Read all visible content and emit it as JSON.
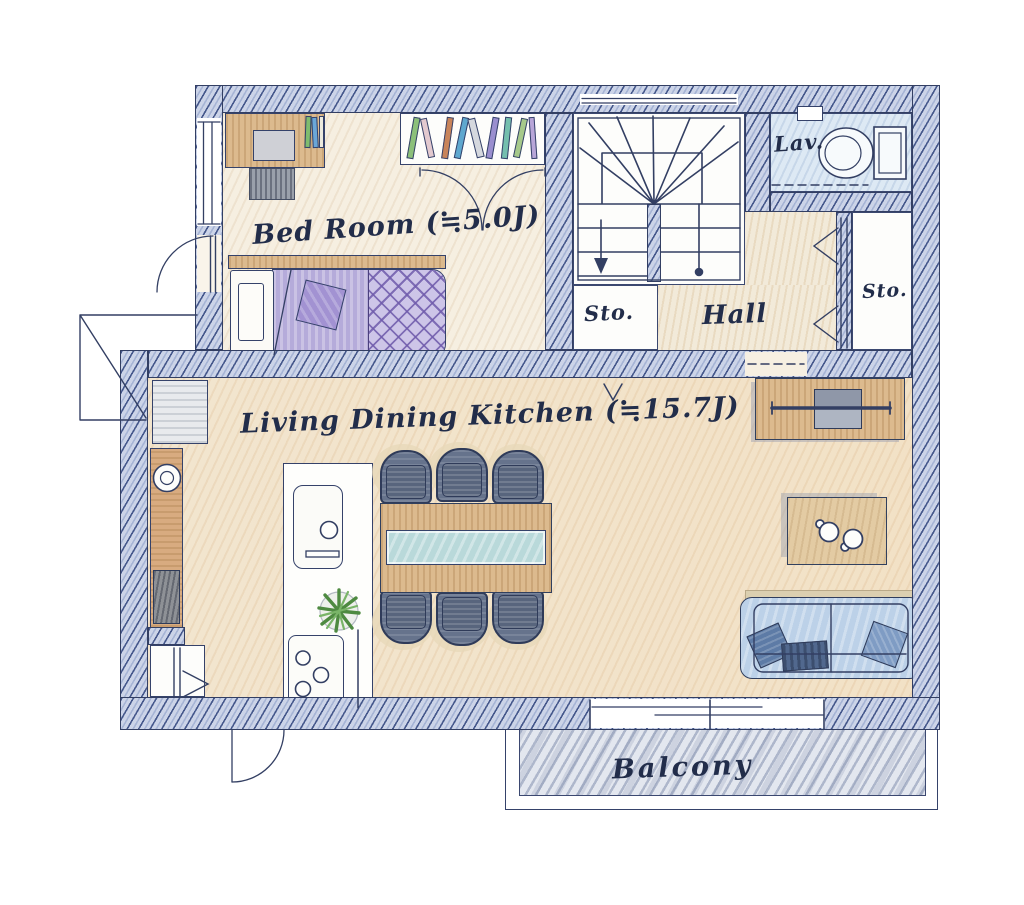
{
  "rooms": {
    "bedroom": {
      "label": "Bed Room (≒5.0J)"
    },
    "ldk": {
      "label": "Living Dining Kitchen (≒15.7J)"
    },
    "hall": {
      "label": "Hall"
    },
    "storage_left": {
      "label": "Sto."
    },
    "storage_right": {
      "label": "Sto."
    },
    "lavatory": {
      "label": "Lav."
    },
    "balcony": {
      "label": "Balcony"
    }
  },
  "furniture_icons": {
    "bedroom": [
      "desk",
      "laptop",
      "desk-chair",
      "desk-books",
      "bookshelf",
      "closet-double-doors",
      "single-bed",
      "pillow",
      "cushion"
    ],
    "stair": [
      "u-turn-staircase",
      "down-arrow",
      "handrail-dot"
    ],
    "lavatory": [
      "toilet",
      "paper-holder"
    ],
    "ldk": [
      "refrigerator",
      "kitchen-counter",
      "round-sink",
      "gas-range",
      "storage-closet",
      "island-counter",
      "island-sink",
      "faucet",
      "cooktop-burners",
      "potted-plant",
      "dining-table",
      "glass-runner",
      "dining-chair",
      "tv-board",
      "tv",
      "coffee-table",
      "mug",
      "sofa",
      "throw-pillow",
      "blanket"
    ],
    "doors": [
      "bedroom-swing-door",
      "closet-bifold-arcs",
      "folding-door-triangles",
      "exterior-swing-door",
      "sliding-window",
      "threshold-dashes",
      "step-arrow"
    ]
  },
  "colors": {
    "line": "#333f63",
    "wall_hatch_base": "#ccd4e8",
    "bedroom_floor": "#f6efe1",
    "ldk_floor": "#f4e8d3",
    "hall_floor": "#f2ead9",
    "lav_floor": "#dde9f4",
    "bed_purple": "#b5abda",
    "plaid_purple": "#cdc5e8",
    "cushion_purple": "#a292d2",
    "sofa_blue": "#bcd1e8",
    "pillow_blue": "#5d7ba6",
    "wood": "#dcba8e",
    "chair_slate": "#66738c",
    "glass_teal": "#b9d9da",
    "plant_green": "#4e8a41",
    "balcony_gray": "#e3e7ef"
  }
}
